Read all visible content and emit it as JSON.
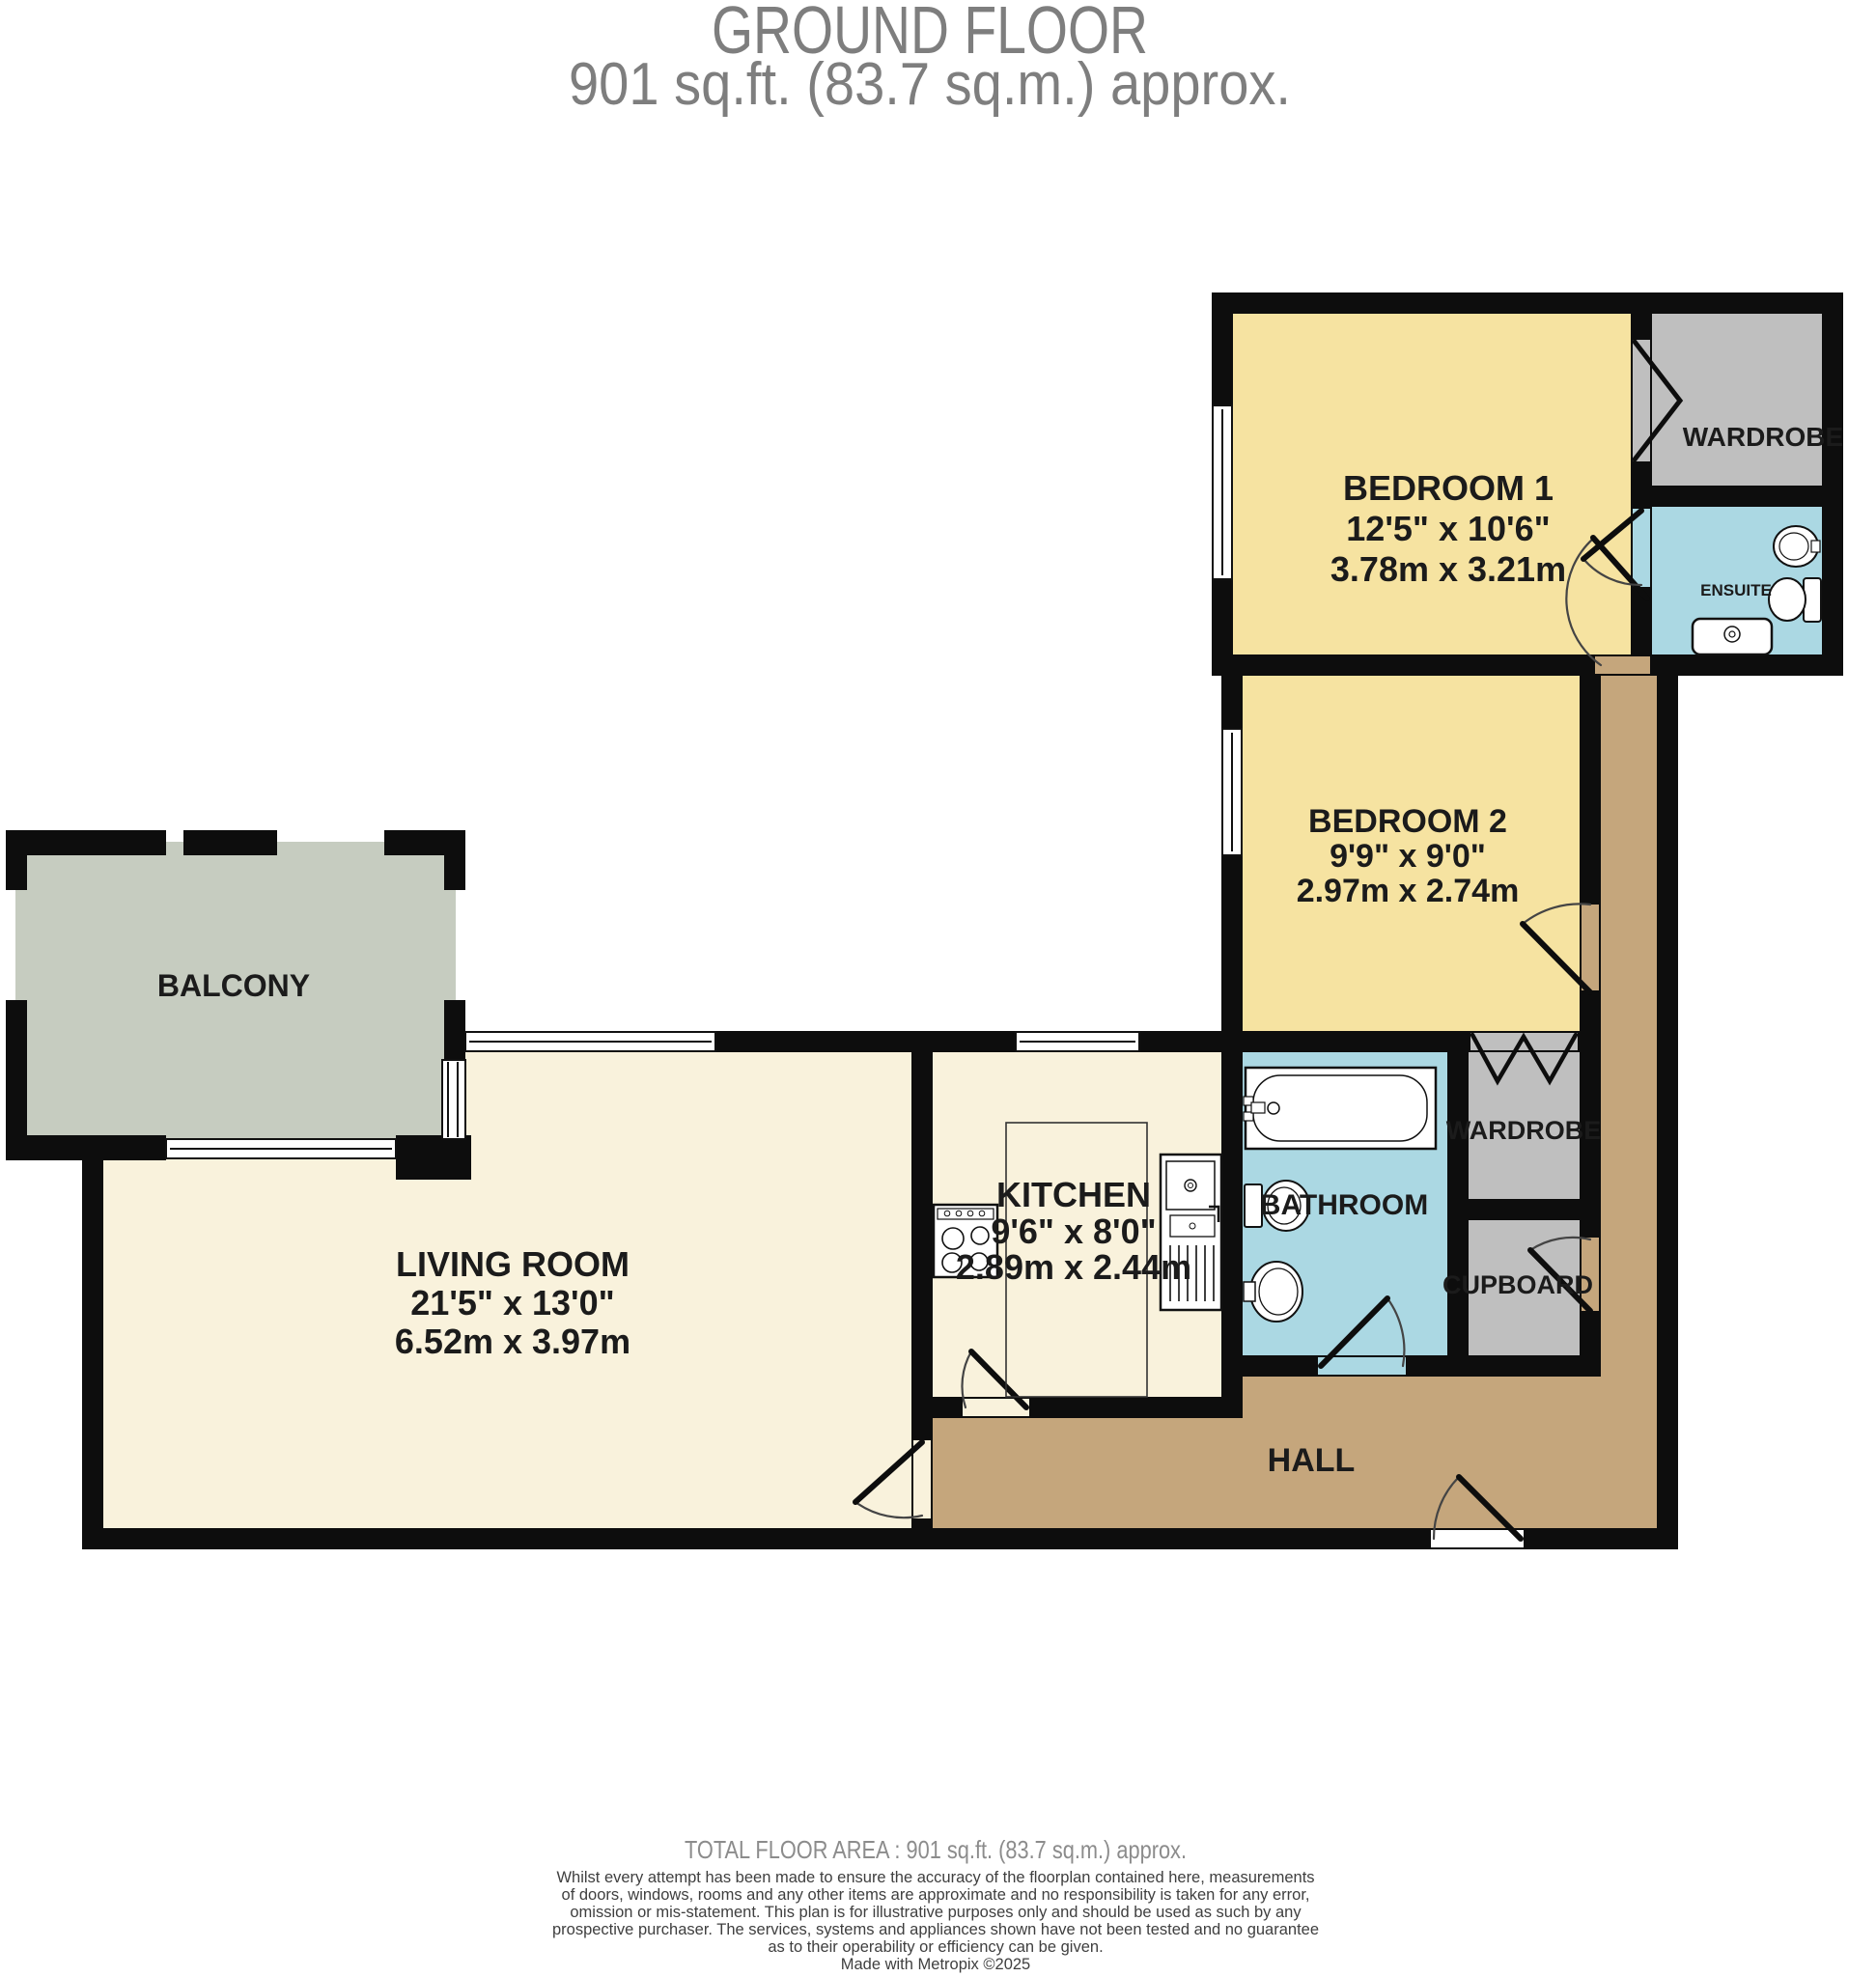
{
  "title": {
    "line1": "GROUND FLOOR",
    "line2": "901 sq.ft. (83.7 sq.m.) approx."
  },
  "rooms": {
    "bedroom1": {
      "name": "BEDROOM 1",
      "imperial": "12'5\" x 10'6\"",
      "metric": "3.78m x 3.21m"
    },
    "bedroom2": {
      "name": "BEDROOM 2",
      "imperial": "9'9\" x 9'0\"",
      "metric": "2.97m x 2.74m"
    },
    "living_room": {
      "name": "LIVING ROOM",
      "imperial": "21'5\" x 13'0\"",
      "metric": "6.52m x 3.97m"
    },
    "kitchen": {
      "name": "KITCHEN",
      "imperial": "9'6\" x 8'0\"",
      "metric": "2.89m x 2.44m"
    },
    "bathroom": {
      "name": "BATHROOM"
    },
    "ensuite": {
      "name": "ENSUITE"
    },
    "wardrobe_bedroom1": {
      "name": "WARDROBE"
    },
    "wardrobe_bedroom2": {
      "name": "WARDROBE"
    },
    "cupboard": {
      "name": "CUPBOARD"
    },
    "hall": {
      "name": "HALL"
    },
    "balcony": {
      "name": "BALCONY"
    }
  },
  "footer": {
    "total_area": "TOTAL FLOOR AREA : 901 sq.ft. (83.7 sq.m.) approx.",
    "disclaimer_lines": [
      "Whilst every attempt has been made to ensure the accuracy of the floorplan contained here, measurements",
      "of doors, windows, rooms and any other items are approximate and no responsibility is taken for any error,",
      "omission or mis-statement. This plan is for illustrative purposes only and should be used as such by any",
      "prospective purchaser. The services, systems and appliances shown have not been tested and no guarantee",
      "as to their operability or efficiency can be given."
    ],
    "credit": "Made with Metropix ©2025"
  },
  "colors": {
    "wall": "#0d0d0d",
    "bedroom": "#f6e3a1",
    "living": "#f9f2dc",
    "hall": "#c5a67c",
    "bath": "#abd8e3",
    "wardrobe": "#bfbfbf",
    "balcony": "#c6ccc0",
    "label": "#1b1b1b",
    "title_gray": "#7e7e7e",
    "footer_gray": "#3f3f3f"
  }
}
